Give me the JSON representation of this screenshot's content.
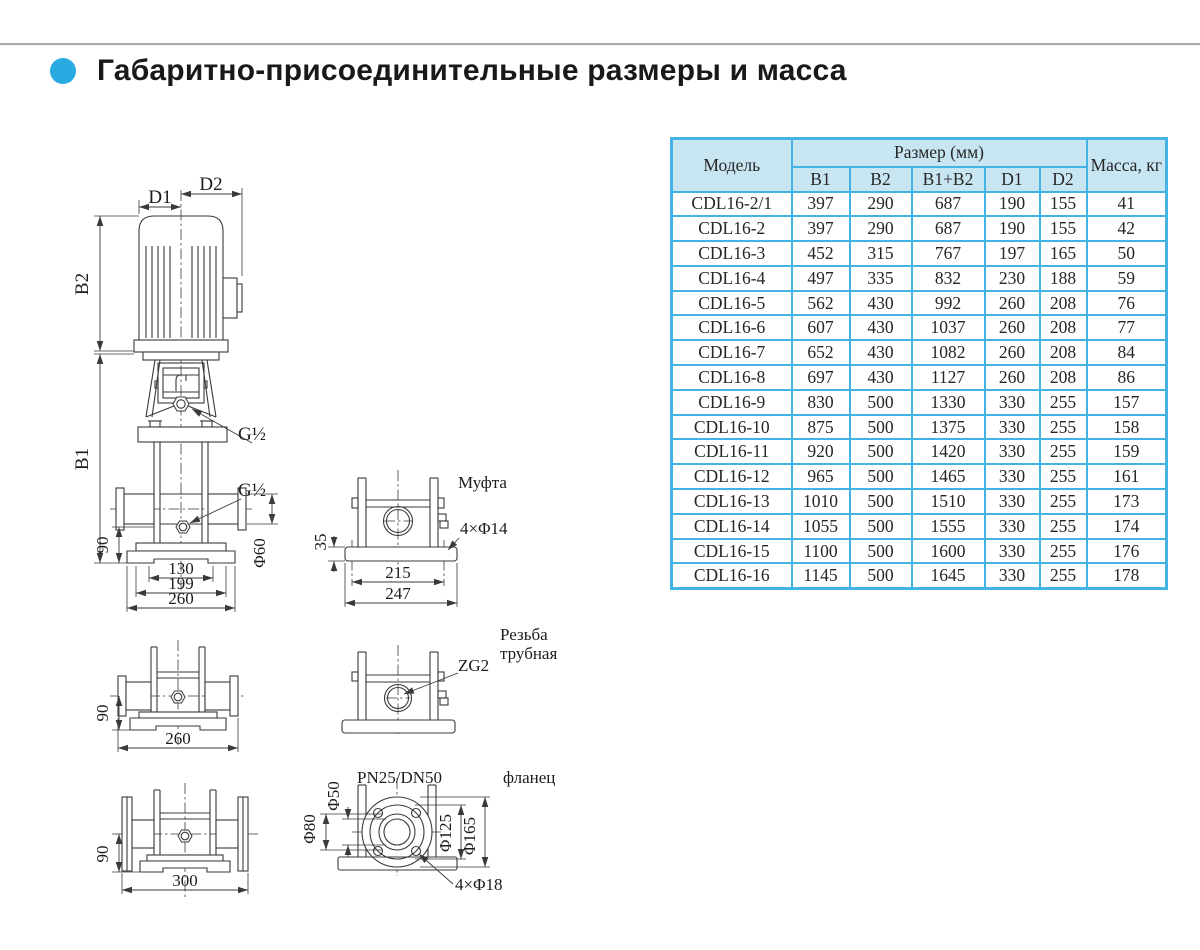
{
  "title": "Габаритно-присоединительные размеры и масса",
  "colors": {
    "accent": "#29abe2",
    "table_border": "#44b2e2",
    "table_header_bg": "#c8e6f2",
    "line": "#3a3a3a"
  },
  "table": {
    "header": {
      "model": "Модель",
      "size_group": "Размер (мм)",
      "size_cols": [
        "B1",
        "B2",
        "B1+B2",
        "D1",
        "D2"
      ],
      "mass": "Масса, кг"
    },
    "rows": [
      [
        "CDL16-2/1",
        397,
        290,
        687,
        190,
        155,
        41
      ],
      [
        "CDL16-2",
        397,
        290,
        687,
        190,
        155,
        42
      ],
      [
        "CDL16-3",
        452,
        315,
        767,
        197,
        165,
        50
      ],
      [
        "CDL16-4",
        497,
        335,
        832,
        230,
        188,
        59
      ],
      [
        "CDL16-5",
        562,
        430,
        992,
        260,
        208,
        76
      ],
      [
        "CDL16-6",
        607,
        430,
        1037,
        260,
        208,
        77
      ],
      [
        "CDL16-7",
        652,
        430,
        1082,
        260,
        208,
        84
      ],
      [
        "CDL16-8",
        697,
        430,
        1127,
        260,
        208,
        86
      ],
      [
        "CDL16-9",
        830,
        500,
        1330,
        330,
        255,
        157
      ],
      [
        "CDL16-10",
        875,
        500,
        1375,
        330,
        255,
        158
      ],
      [
        "CDL16-11",
        920,
        500,
        1420,
        330,
        255,
        159
      ],
      [
        "CDL16-12",
        965,
        500,
        1465,
        330,
        255,
        161
      ],
      [
        "CDL16-13",
        1010,
        500,
        1510,
        330,
        255,
        173
      ],
      [
        "CDL16-14",
        1055,
        500,
        1555,
        330,
        255,
        174
      ],
      [
        "CDL16-15",
        1100,
        500,
        1600,
        330,
        255,
        176
      ],
      [
        "CDL16-16",
        1145,
        500,
        1645,
        330,
        255,
        178
      ]
    ]
  },
  "drawings": {
    "front_view": {
      "d1": "D1",
      "d2": "D2",
      "b1": "B1",
      "b2": "B2",
      "g_half_top": "G½",
      "g_half_side": "G½",
      "phi60": "Φ60",
      "dim90": "90",
      "dim130": "130",
      "dim199": "199",
      "dim260": "260"
    },
    "coupling_view": {
      "title": "Муфта",
      "holes": "4×Φ14",
      "dim35": "35",
      "dim215": "215",
      "dim247": "247"
    },
    "oval_view": {
      "dim90": "90",
      "dim260": "260"
    },
    "thread_view": {
      "title1": "Резьба",
      "title2": "трубная",
      "zg2": "ZG2"
    },
    "flange_front_view": {
      "dim90": "90",
      "dim300": "300"
    },
    "flange_view": {
      "pn": "PN25/DN50",
      "title": "фланец",
      "phi50": "Φ50",
      "phi80": "Φ80",
      "phi125": "Φ125",
      "phi165": "Φ165",
      "holes": "4×Φ18"
    }
  }
}
